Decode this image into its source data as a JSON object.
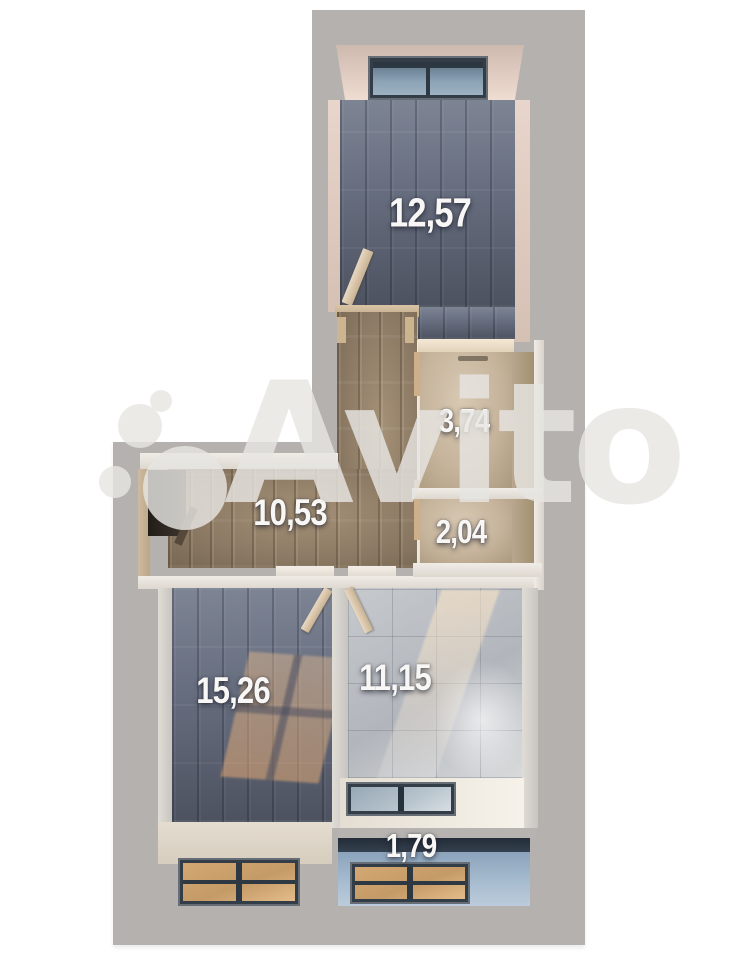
{
  "plan": {
    "watermark": {
      "brand": "Avito"
    },
    "rooms": [
      {
        "id": "room-top-bedroom",
        "area": "12,57"
      },
      {
        "id": "room-bathroom",
        "area": "3,74"
      },
      {
        "id": "room-wc",
        "area": "2,04"
      },
      {
        "id": "hallway",
        "area": "10,53"
      },
      {
        "id": "room-living",
        "area": "15,26"
      },
      {
        "id": "room-kitchen",
        "area": "11,15"
      },
      {
        "id": "balcony",
        "area": "1,79"
      }
    ],
    "colors": {
      "background_gray": "#b4b1af",
      "label_white": "#f8f7f5",
      "dark_floor": "#666d7e",
      "wood_floor": "#8d7b65",
      "beige_floor": "#c6b49c",
      "tile_floor": "#b9bdc2",
      "balcony_floor": "#a2b8cc",
      "watermark": "#e8e6e3"
    }
  }
}
